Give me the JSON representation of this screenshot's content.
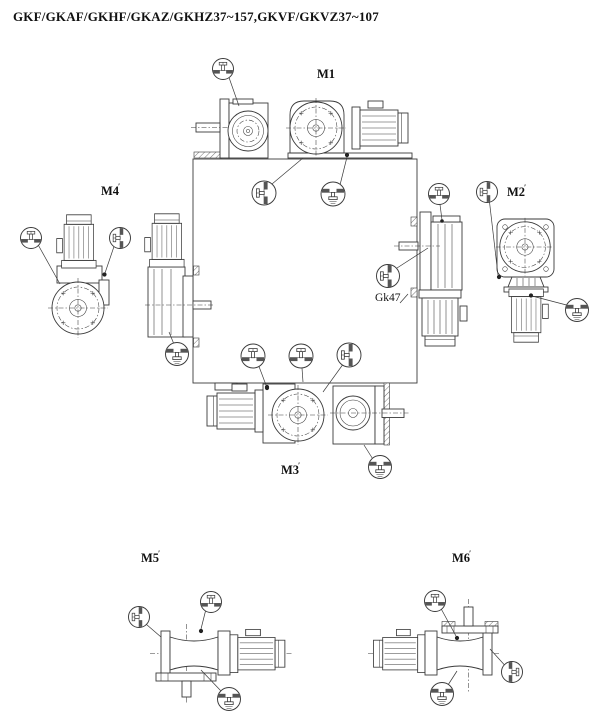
{
  "page": {
    "title": "GKF/GKAF/GKHF/GKAZ/GKHZ37~157,GKVF/GKVZ37~107"
  },
  "positions": {
    "m1": {
      "label": "M1",
      "mark": ""
    },
    "m2": {
      "label": "M2",
      "mark": "′"
    },
    "m3": {
      "label": "M3",
      "mark": "′"
    },
    "m4": {
      "label": "M4",
      "mark": "′"
    },
    "m5": {
      "label": "M5",
      "mark": "′"
    },
    "m6": {
      "label": "M6",
      "mark": "′"
    }
  },
  "annotations": {
    "gk47_label": "Gk47"
  },
  "colors": {
    "line": "#3a3a3a",
    "text": "#111111",
    "plug_symbol_fill": "#555555",
    "background": "#ffffff"
  }
}
